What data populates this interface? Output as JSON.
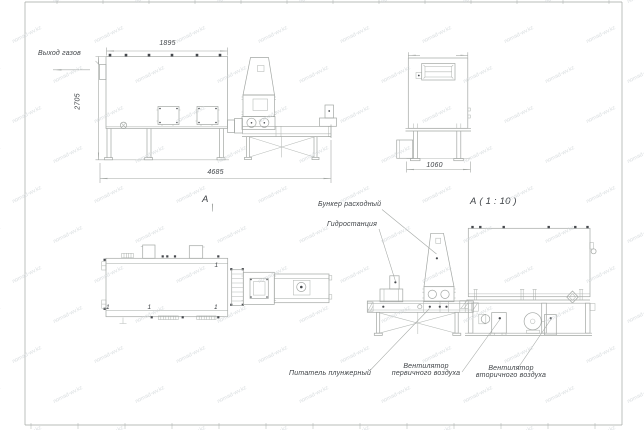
{
  "colors": {
    "line": "#a3a7a4",
    "dark": "#45484c",
    "text": "#3f4347",
    "watermark": "#d2d7da"
  },
  "watermark": {
    "text": "nomad-wv.kz"
  },
  "annotations": {
    "gas_outlet": "Выход газов",
    "view_label": "А",
    "detail_title": "А ( 1 : 10 )",
    "bunker": "Бункер расходный",
    "hydrostation": "Гидростанция",
    "plunger_feeder": "Питатель плунжерный",
    "primary_fan": [
      "Вентилятор",
      "первичного воздуха"
    ],
    "secondary_fan": [
      "Вентилятор",
      "вторичного воздуха"
    ]
  },
  "dimensions": {
    "furnace_width": "1895",
    "furnace_height": "2705",
    "overall_length": "4685",
    "end_view_width": "1060"
  },
  "position_markers": [
    "1",
    "1",
    "1",
    "1"
  ]
}
